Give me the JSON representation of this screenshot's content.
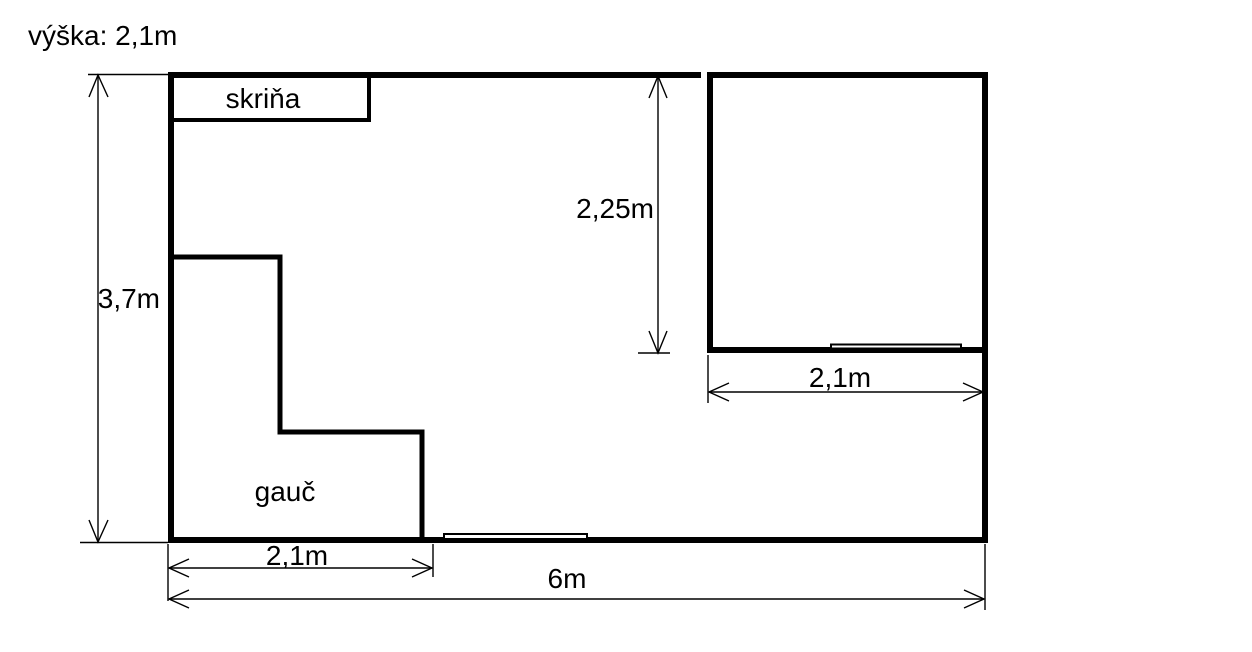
{
  "colors": {
    "background": "#ffffff",
    "line": "#000000",
    "text": "#000000"
  },
  "note": {
    "ceiling_height": "výška: 2,1m"
  },
  "room": {
    "depth_label": "3,7m",
    "width_label": "6m"
  },
  "wardrobe": {
    "label": "skriňa"
  },
  "couch": {
    "label": "gauč",
    "width_label": "2,1m"
  },
  "inner_room": {
    "depth_label": "2,25m",
    "width_label": "2,1m"
  }
}
